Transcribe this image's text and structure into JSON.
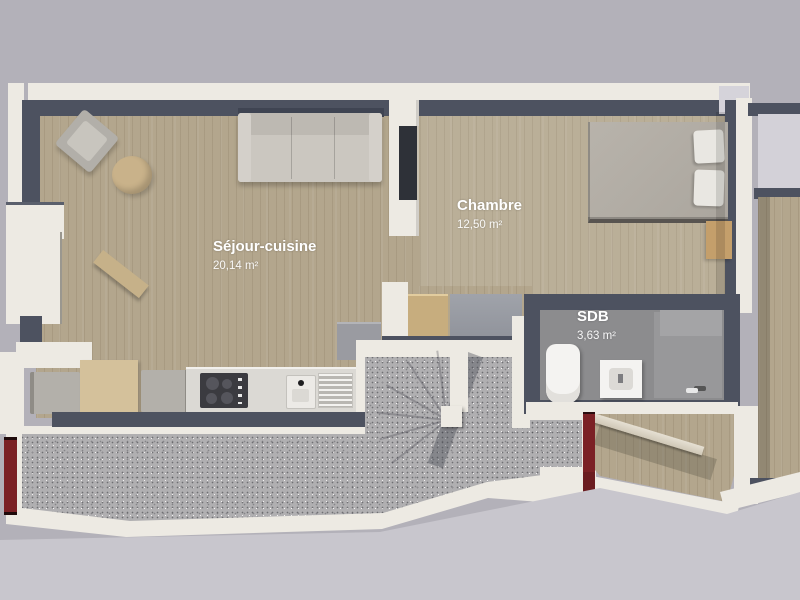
{
  "plan": {
    "title": "apartment-floor-plan-3d",
    "rooms": [
      {
        "id": "sejour",
        "name": "Séjour-cuisine",
        "area": "20,14 m²"
      },
      {
        "id": "chambre",
        "name": "Chambre",
        "area": "12,50 m²"
      },
      {
        "id": "sdb",
        "name": "SDB",
        "area": "3,63 m²"
      }
    ]
  },
  "colors": {
    "bg": "#b3b1b9",
    "bg_bottom": "#c8c6cd",
    "wall_outer": "#edeae3",
    "wall_dark": "#4d5260",
    "floor_wood": "#b3a68d",
    "floor_wood_light": "#beb199",
    "floor_bath": "#8c8c8e",
    "floor_stone": "#b0afb1",
    "door_red": "#7b2125",
    "sofa_gray": "#cbc7c0",
    "label_text": "#ffffff"
  }
}
